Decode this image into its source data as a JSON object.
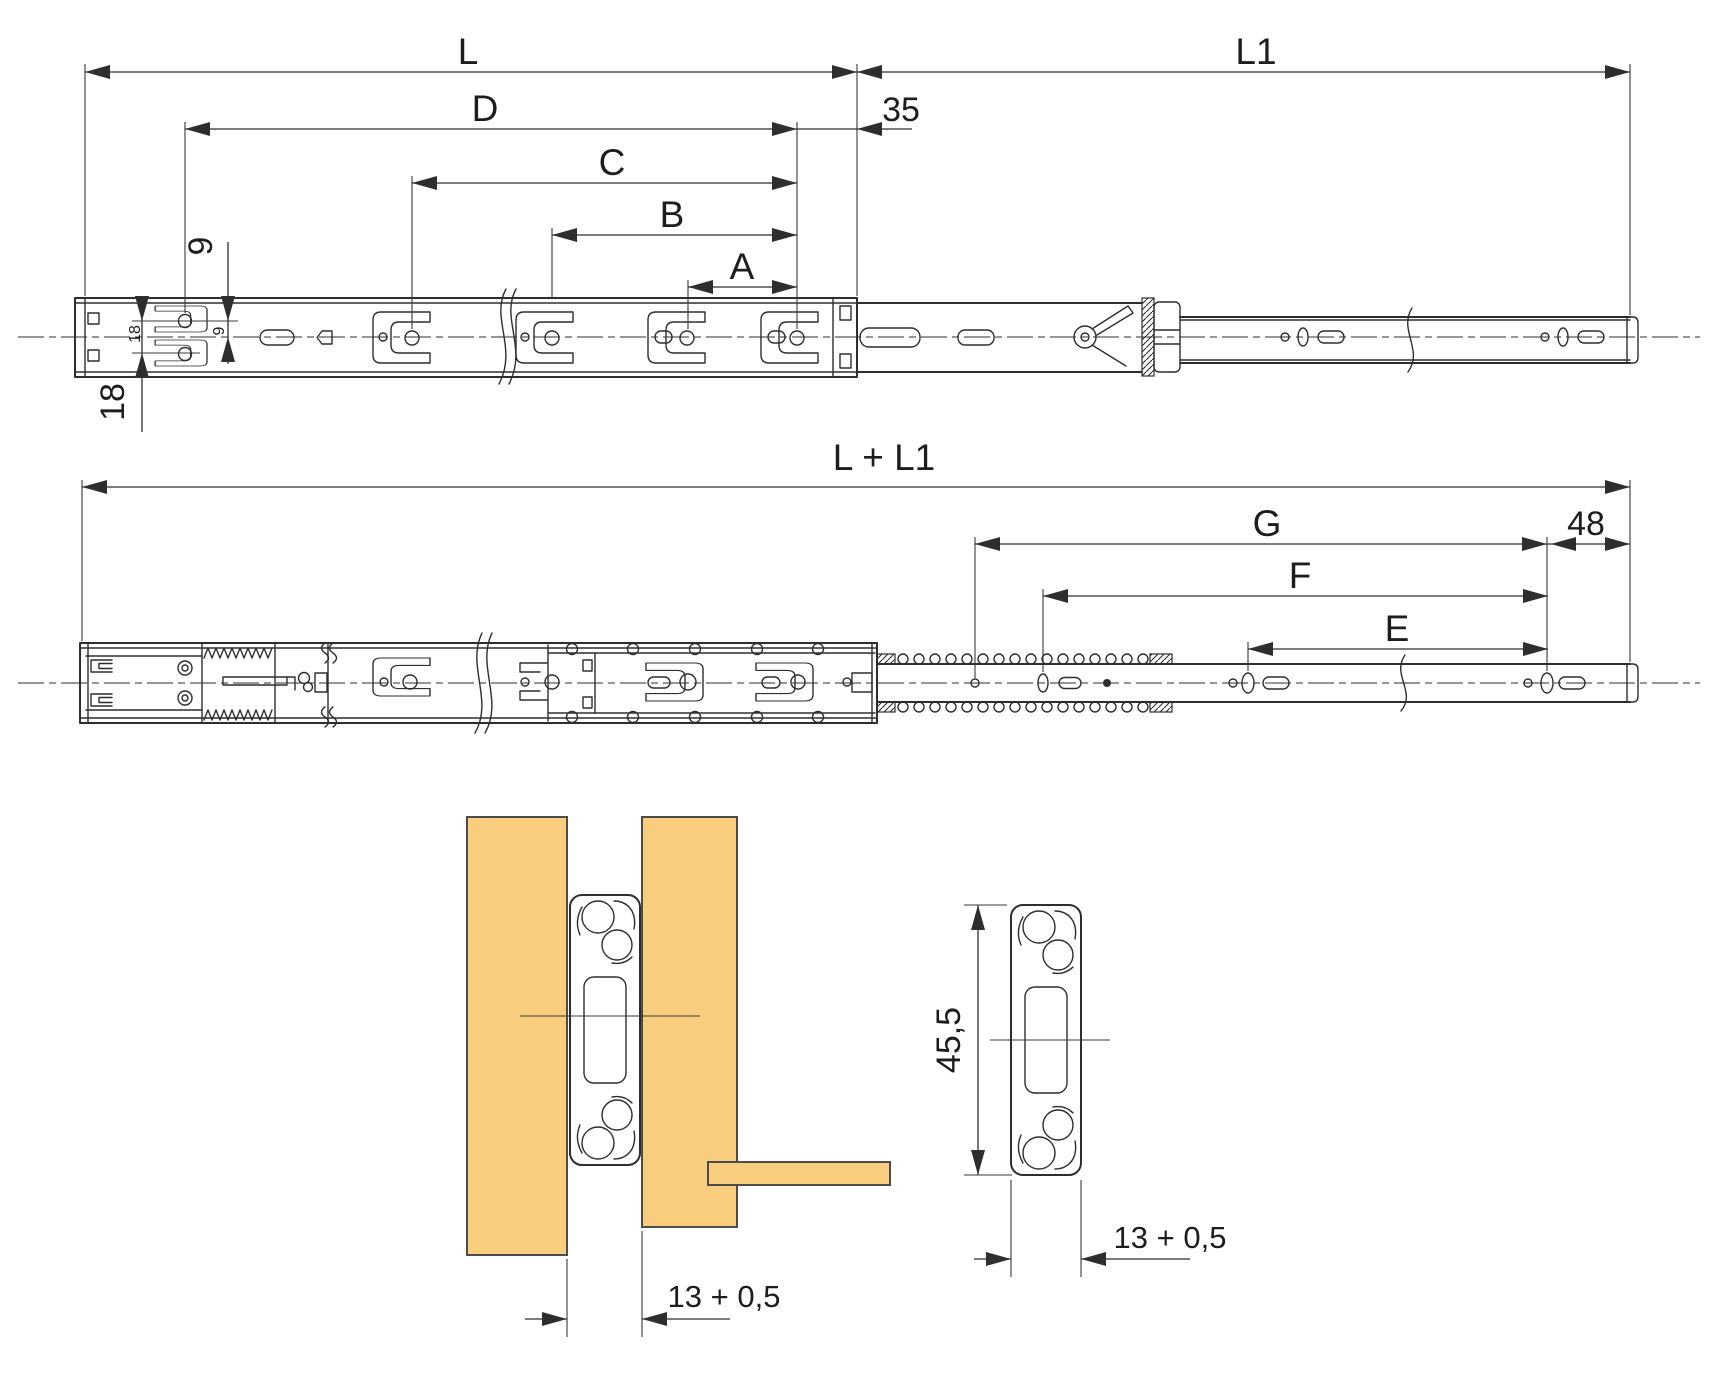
{
  "colors": {
    "line": "#2e2e2e",
    "dimension": "#2e2e2e",
    "panel_fill": "#f8ce7e",
    "panel_stroke": "#4c4c4c",
    "background": "#ffffff"
  },
  "views": {
    "closed": {
      "dims": {
        "L": "L",
        "L1": "L1",
        "D": "D",
        "C": "C",
        "B": "B",
        "A": "A",
        "front_offset": "35",
        "hole_to_center": "9",
        "hole_to_center_small": "9",
        "hole_spacing": "18",
        "hole_spacing_small": "18"
      }
    },
    "extended": {
      "dims": {
        "total_length": "L + L1",
        "G": "G",
        "F": "F",
        "E": "E",
        "rear_offset": "48"
      }
    },
    "mounting_section": {
      "dims": {
        "panel_gap": "13 + 0,5"
      }
    },
    "profile_section": {
      "dims": {
        "profile_height": "45,5",
        "profile_width": "13 + 0,5"
      }
    }
  }
}
